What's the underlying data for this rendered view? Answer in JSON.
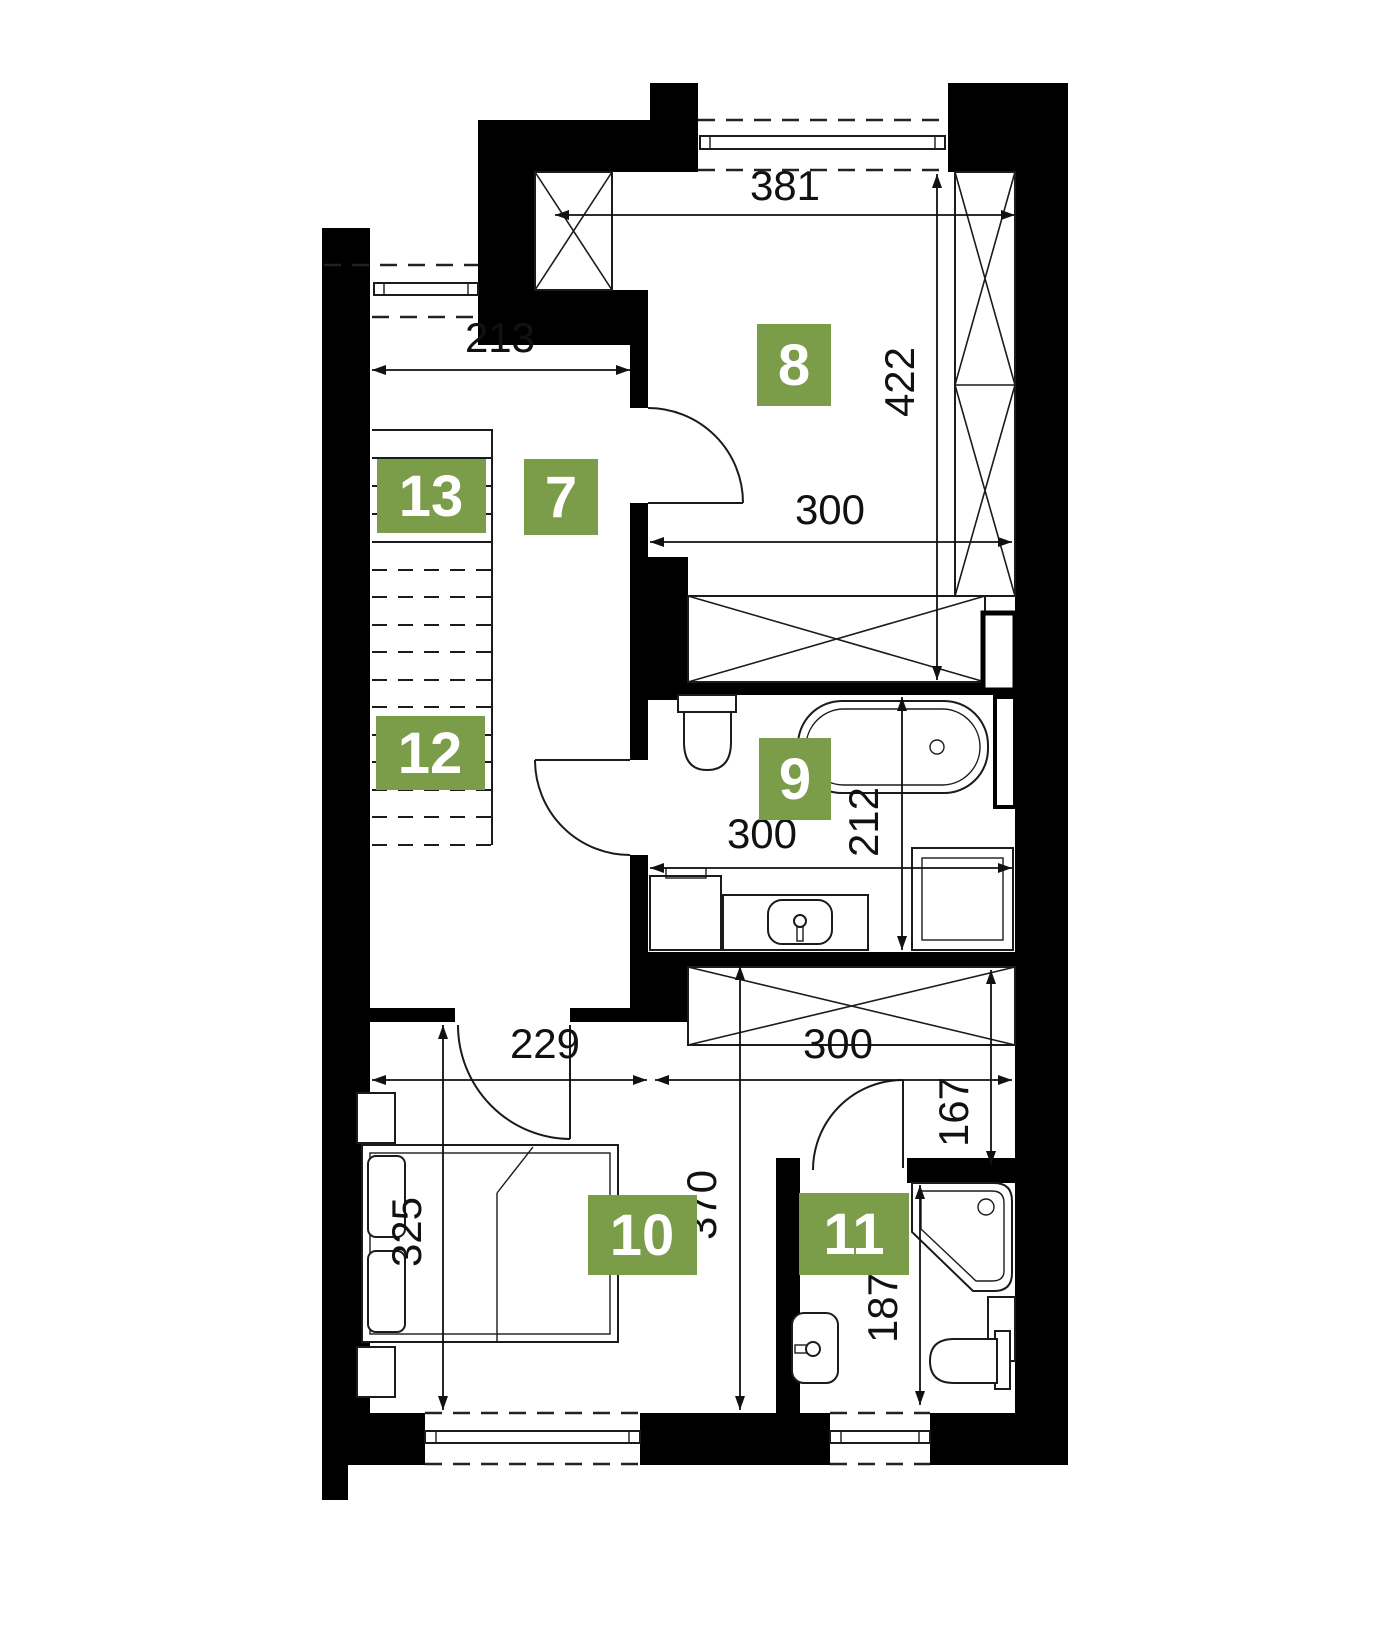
{
  "plan": {
    "accent_color": "#7b9c48",
    "rooms": [
      {
        "id": "room-7",
        "number": "7"
      },
      {
        "id": "room-8",
        "number": "8"
      },
      {
        "id": "room-9",
        "number": "9"
      },
      {
        "id": "room-10",
        "number": "10"
      },
      {
        "id": "room-11",
        "number": "11"
      },
      {
        "id": "room-12",
        "number": "12"
      },
      {
        "id": "room-13",
        "number": "13"
      }
    ],
    "dimensions": {
      "room8_top": "381",
      "room8_side": "422",
      "hall_top": "213",
      "room8_bottom": "300",
      "bath9_width": "300",
      "bath9_side": "212",
      "room10_top": "229",
      "closet_top": "300",
      "corridor_side": "167",
      "room10_side": "370",
      "bed_side": "325",
      "bath11_side": "187"
    }
  }
}
